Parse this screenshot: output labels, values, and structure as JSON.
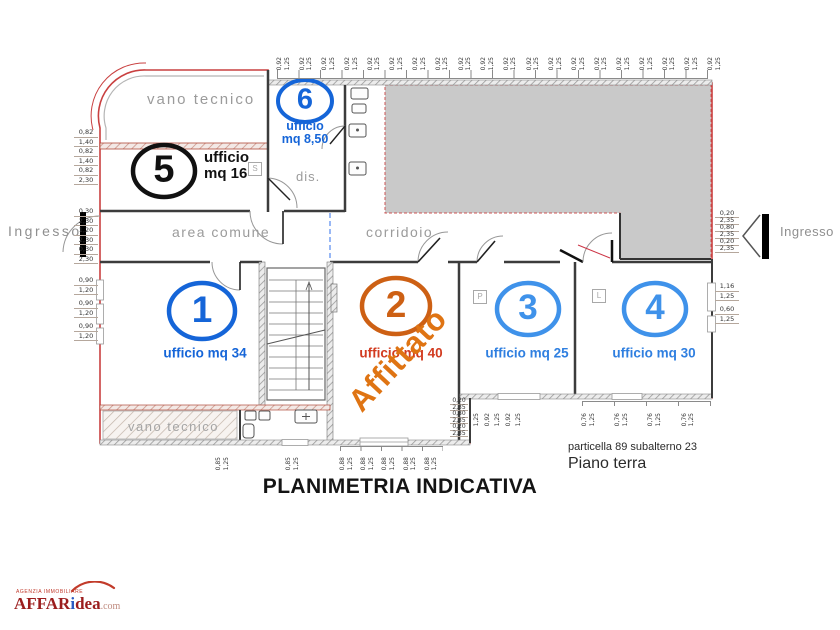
{
  "plan": {
    "labels": {
      "vano_tecnico_top": "vano tecnico",
      "vano_tecnico_bottom": "vano tecnico",
      "area_comune": "area comune",
      "corridoio": "corridoio",
      "dis": "dis.",
      "ingresso_left": "Ingresso",
      "ingresso_right": "Ingresso"
    },
    "rooms": {
      "r1": {
        "number": "1",
        "label": "ufficio mq 34"
      },
      "r2": {
        "number": "2",
        "label": "ufficio mq 40",
        "status": "Affittato"
      },
      "r3": {
        "number": "3",
        "label": "ufficio mq 25"
      },
      "r4": {
        "number": "4",
        "label": "ufficio mq 30"
      },
      "r5": {
        "number": "5",
        "line1": "ufficio",
        "line2": "mq 16"
      },
      "r6": {
        "number": "6",
        "line1": "ufficio",
        "line2": "mq 8,50"
      }
    },
    "symbols": {
      "s": "S",
      "p": "P",
      "l": "L"
    },
    "dims": {
      "top": [
        "0,92",
        "1,25",
        "0,92",
        "1,25",
        "0,92",
        "1,25",
        "0,92",
        "1,25",
        "0,92",
        "1,25",
        "0,92",
        "1,25",
        "0,92",
        "1,25",
        "0,92",
        "1,25",
        "0,92",
        "1,25",
        "0,92",
        "1,25",
        "0,92",
        "1,25",
        "0,92",
        "1,25",
        "0,92",
        "1,25",
        "0,92",
        "1,25",
        "0,92",
        "1,25",
        "0,92",
        "1,25",
        "0,92",
        "1,25",
        "0,92",
        "1,25",
        "0,92",
        "1,25",
        "0,92",
        "1,25"
      ],
      "left_a": [
        "0,82",
        "1,40",
        "0,82",
        "1,40",
        "0,82",
        "2,30"
      ],
      "left_b": [
        "0,30",
        "2,30",
        "1,20",
        "2,30",
        "0,30",
        "2,30"
      ],
      "left_c": [
        "0,90",
        "1,20",
        "0,90",
        "1,20",
        "0,90",
        "1,20"
      ],
      "right_a": [
        "0,20",
        "2,35",
        "0,80",
        "2,35",
        "0,20",
        "2,35"
      ],
      "right_b": [
        "1,16",
        "1,25",
        "0,60",
        "1,25"
      ],
      "bottom_a": [
        "0,85",
        "1,25"
      ],
      "bottom_b": [
        "0,85",
        "1,25"
      ],
      "bottom_c": [
        "0,88",
        "1,25",
        "0,88",
        "1,25",
        "0,88",
        "1,25",
        "0,88",
        "1,25",
        "0,88",
        "1,25"
      ],
      "bottom_d": [
        "1,25",
        "0,92",
        "1,25",
        "0,92",
        "1,25"
      ],
      "bottom_e": [
        "0,76",
        "1,25",
        "0,76",
        "1,25",
        "0,76",
        "1,25",
        "0,76",
        "1,25"
      ],
      "mid_stack": [
        "0,20",
        "2,35",
        "0,80",
        "2,35",
        "0,20",
        "2,35"
      ]
    }
  },
  "footer": {
    "particella": "particella 89 subalterno 23",
    "floor": "Piano terra",
    "title": "PLANIMETRIA INDICATIVA"
  },
  "logo": {
    "tagline": "AGENZIA IMMOBILIARE",
    "part1": "AFFAR",
    "part2": "i",
    "part3": "dea",
    "part4": ".com"
  },
  "colors": {
    "boundary_red": "#c94040",
    "blue_dark": "#1565d8",
    "blue_light": "#3f92ea",
    "orange": "#cd6014",
    "red_orange": "#d23b20",
    "affittato_orange": "#df7413",
    "gray_fill": "#c9c9c9"
  }
}
